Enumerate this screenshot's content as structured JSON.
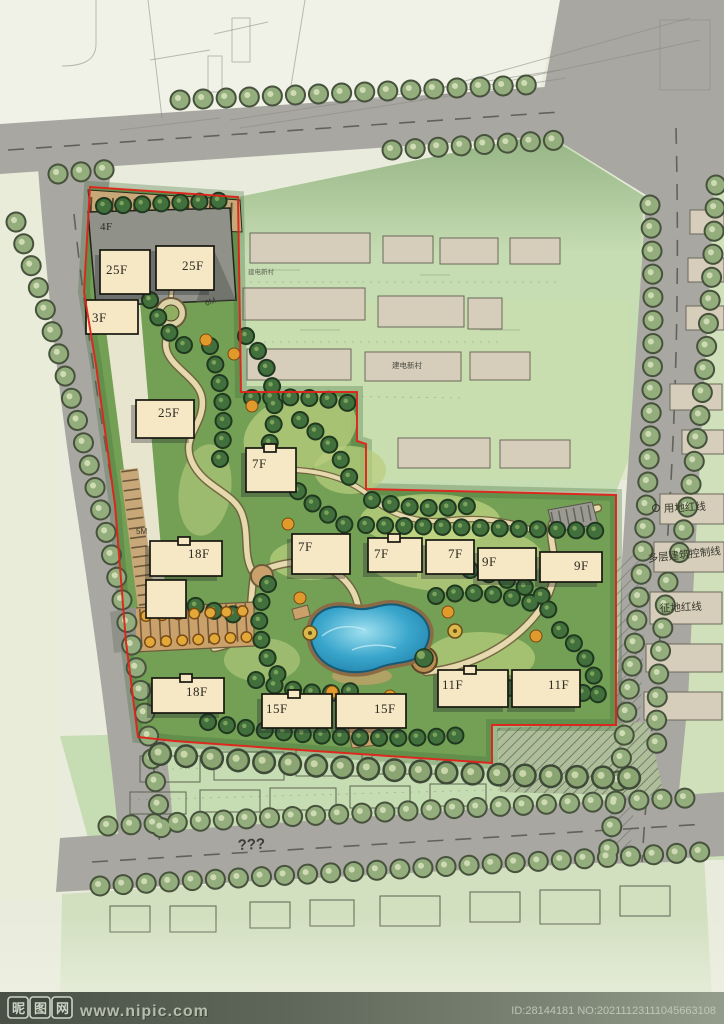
{
  "plan": {
    "building_labels": [
      {
        "label": "4F"
      },
      {
        "label": "25F"
      },
      {
        "label": "25F"
      },
      {
        "label": "3F"
      },
      {
        "label": "25F"
      },
      {
        "label": "7F"
      },
      {
        "label": "18F"
      },
      {
        "label": "7F"
      },
      {
        "label": "7F"
      },
      {
        "label": "7F"
      },
      {
        "label": "9F"
      },
      {
        "label": "9F"
      },
      {
        "label": "18F"
      },
      {
        "label": "15F"
      },
      {
        "label": "15F"
      },
      {
        "label": "11F"
      },
      {
        "label": "11F"
      }
    ],
    "road_width_labels": [
      {
        "text": "6M"
      },
      {
        "text": "5M"
      }
    ],
    "unknown_road_label": "???"
  },
  "context": {
    "boundary_labels": [
      {
        "text": "用地红线"
      },
      {
        "text": "多层建筑控制线"
      },
      {
        "text": "征地红线"
      }
    ],
    "village_labels": [
      {
        "text": "建电新村"
      },
      {
        "text": "建电新村"
      }
    ]
  },
  "watermark": {
    "logo_chars": [
      {
        "ch": "昵"
      },
      {
        "ch": "图"
      },
      {
        "ch": "网"
      }
    ],
    "url": "www.nipic.com",
    "id_text": "ID:28144181 NO:20211123111045663108"
  },
  "colors": {
    "boundary_red": "#e0231a",
    "site_green": "#74a055",
    "pool_blue": "#45b7d9",
    "road_gray": "#a8a7a1",
    "building_cream": "#f6e7c5"
  }
}
